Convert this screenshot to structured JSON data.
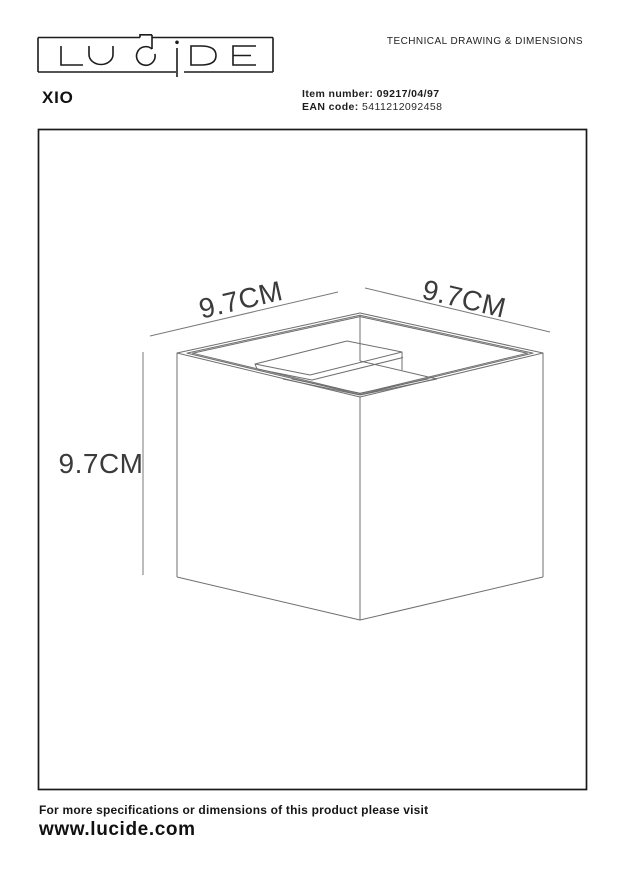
{
  "page": {
    "background": "#ffffff"
  },
  "header": {
    "logo": {
      "text": "LUCIDE"
    },
    "doc_type": "TECHNICAL DRAWING & DIMENSIONS",
    "product_name": "XIO",
    "item": {
      "label": "Item number:",
      "value": "09217/04/97"
    },
    "ean": {
      "label": "EAN code:",
      "value": "5411212092458"
    }
  },
  "drawing": {
    "dim_top_left": "9.7CM",
    "dim_top_right": "9.7CM",
    "dim_height": "9.7CM",
    "line_color": "#6f6f6f"
  },
  "footer": {
    "note": "For more specifications or dimensions of this product please visit",
    "website": "www.lucide.com"
  }
}
